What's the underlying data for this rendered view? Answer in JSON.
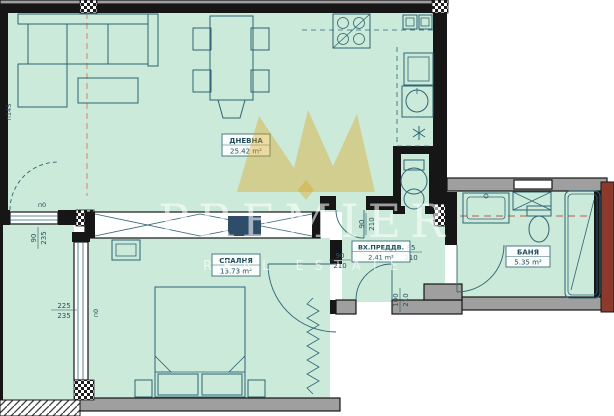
{
  "floorplan": {
    "watermark": {
      "brand": "PREMIER",
      "tagline": "REAL ESTATE"
    },
    "rooms": [
      {
        "name": "ДНЕВНА",
        "area": "25.42 m²"
      },
      {
        "name": "СПАЛНЯ",
        "area": "13.73 m²"
      },
      {
        "name": "ВХ.ПРЕДДВ.",
        "area": "2.41 m²"
      },
      {
        "name": "БАНЯ",
        "area": "5.35 m²"
      }
    ],
    "dimensions": [
      {
        "label": "terrace-door-window",
        "num": "90",
        "den": "235"
      },
      {
        "label": "bedroom-window",
        "num": "225",
        "den": "235"
      },
      {
        "label": "living-hall-door",
        "num": "90",
        "den": "210"
      },
      {
        "label": "bedroom-door",
        "num": "90",
        "den": "210"
      },
      {
        "label": "bathroom-door",
        "num": "85",
        "den": "210"
      },
      {
        "label": "entrance-door",
        "num": "100",
        "den": "210"
      }
    ],
    "annotations": [
      {
        "text": "п145"
      },
      {
        "text": "п0"
      },
      {
        "text": "п0"
      }
    ],
    "colors": {
      "floor": "#cbead9",
      "wall": "#161616",
      "gray_wall": "#9f9f9f",
      "furniture_line": "#2e6475",
      "watermark_gold": "#daa520",
      "adjacent_structure_red": "#8c3a2b",
      "section_line_salmon": "#d98c7a",
      "label_text": "#1f4d5e"
    }
  }
}
